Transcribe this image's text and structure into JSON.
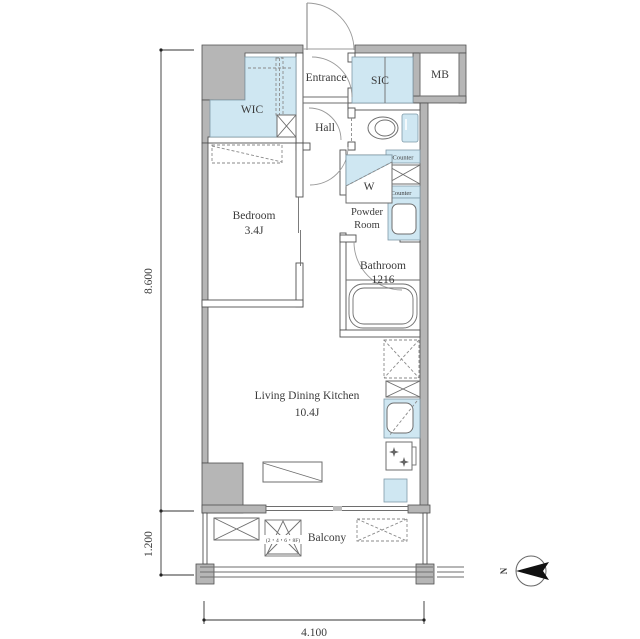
{
  "colors": {
    "wall-fill": "#b6b6b6",
    "wall-stroke": "#4f4f4f",
    "fixture-fill": "#cfe7f2",
    "fixture-stroke": "#7f9aa8",
    "text-color": "#3b3b3b",
    "north-arrow": "#111111"
  },
  "rooms": {
    "entrance": "Entrance",
    "sic": "SIC",
    "mb": "MB",
    "wic": "WIC",
    "hall": "Hall",
    "bedroom_name": "Bedroom",
    "bedroom_size": "3.4J",
    "powder_line1": "Powder",
    "powder_line2": "Room",
    "bathroom_name": "Bathroom",
    "bathroom_size": "1216",
    "ldk_name": "Living Dining Kitchen",
    "ldk_size": "10.4J",
    "balcony": "Balcony",
    "washer": "W"
  },
  "fixtures": {
    "counter_top": "Counter",
    "counter_bottom": "Counter"
  },
  "dimensions": {
    "main_height": "8.600",
    "balcony_depth": "1.200",
    "width": "4.100"
  },
  "annotations": {
    "hatch_floors": "(2・4・6・8F)",
    "north_label": "N"
  }
}
